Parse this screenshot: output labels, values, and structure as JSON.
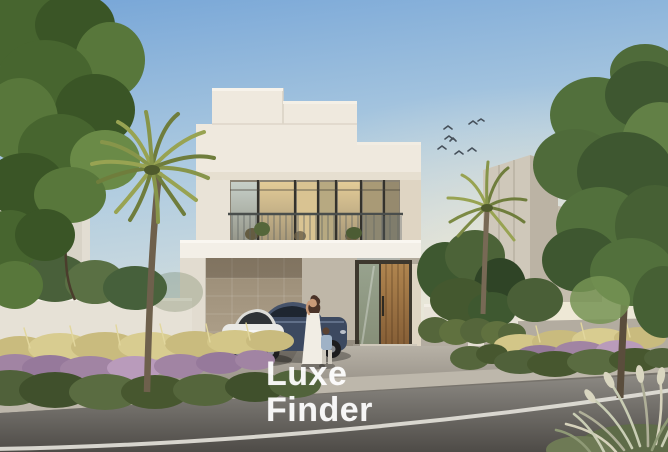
{
  "watermark": {
    "line1": "Luxe",
    "line2": "Finder",
    "color": "#FFFFFF"
  },
  "scene": {
    "alt": "Architectural rendering of a modern two-storey white villa at dusk with a carport, a white sedan and a dark blue car, a woman in a white dress with a child, palm trees, flowering street landscaping, a road in the foreground and a flock of birds in the sky"
  },
  "palette": {
    "sky_top": "#76A5D7",
    "sky_mid": "#AECBE0",
    "sky_horizon": "#E0E4DD",
    "sun_glow": "#F4EAD3",
    "villa_wall": "#EFE9DE",
    "villa_wall_shade": "#DFD5C3",
    "stone_wall": "#AFA18B",
    "door_wood": "#B0854F",
    "glass_warm": "#D9C392",
    "glass_cool": "#BFC8C1",
    "neighbor_building": "#CFC8BA",
    "boundary_wall": "#E6E1D6",
    "pavement": "#ACA69B",
    "curb": "#BDB7AB",
    "road_light": "#8D8A84",
    "road_dark": "#4E4B47",
    "lane_line": "#E3E1D9",
    "foliage_dark": "#3E5830",
    "foliage_light": "#6F8A47",
    "palm_green": "#98A352",
    "palm_green_dark": "#6F7D3C",
    "trunk_brown": "#6E604C",
    "flower_purple": "#A184A3",
    "grass_yellow": "#C9BB7E",
    "plume_grass": "#C9CDB4",
    "car_white": "#E9E9E6",
    "car_blue": "#3C4960",
    "bird": "#46505A"
  }
}
